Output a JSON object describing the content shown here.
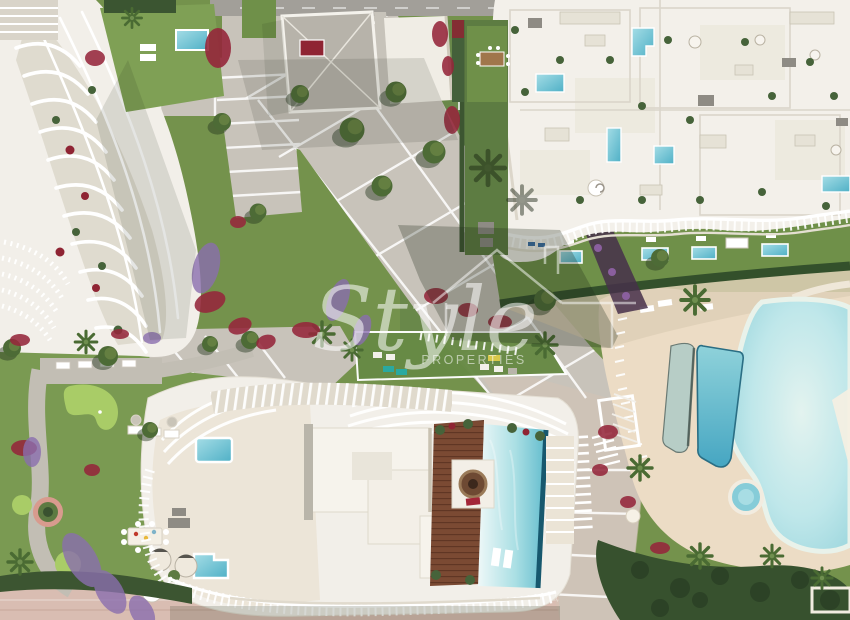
{
  "scene": {
    "type": "aerial-architectural-render",
    "description": "Top-down 3D render of a beachfront residential complex: three white curved apartment buildings, central paved promenade, gardens with putting green, lagoon pool, lap pool, spa, rooftop pools and a wooden sun deck",
    "areas": [
      "north-west-apartment-building",
      "north-center-rooftops",
      "north-east-apartment-building",
      "south-apartment-building",
      "central-promenade",
      "west-garden-putting-green",
      "lagoon-pool",
      "lap-pool",
      "spa-pool",
      "rooftop-pool",
      "wooden-sun-deck",
      "beach-promenade"
    ]
  },
  "watermark": {
    "brand": "Style",
    "subtitle": "PROPERTIES",
    "icon": "house-outline-icon",
    "color": "#ffffff"
  },
  "palette": {
    "building_white": "#f2efe9",
    "grass": "#74924c",
    "grass_dark": "#5d7c42",
    "hedge": "#3c5531",
    "paving": "#c8c3ba",
    "road": "#a29f99",
    "sand_deck": "#ecdcc5",
    "lagoon": "#a9dde2",
    "pool_turquoise": "#56b6cb",
    "pool_pale": "#dff0f2",
    "wood_deck": "#7b4a33",
    "flower_red": "#95273b",
    "flower_purple": "#8a6fae",
    "beach_path": "#d9bdb2"
  }
}
